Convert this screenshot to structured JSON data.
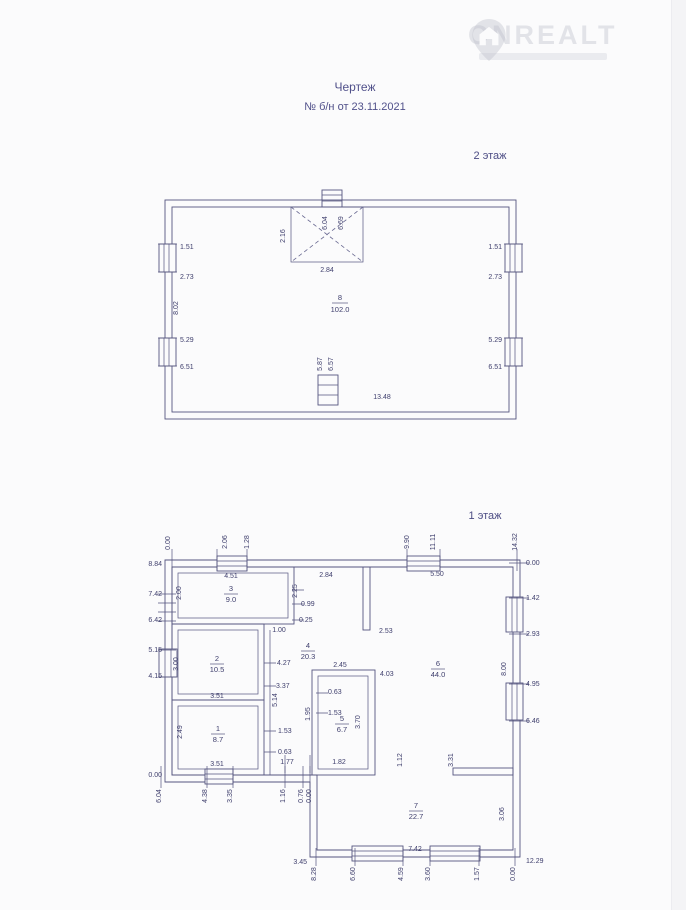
{
  "watermark": {
    "brand": "ONREALT"
  },
  "title": {
    "line1": "Чертеж",
    "line2": "№ б/н от 23.11.2021"
  },
  "colors": {
    "ink": "#55557f",
    "text": "#40406e",
    "accent": "#50508a"
  },
  "floor2": {
    "label": "2 этаж",
    "room": {
      "n": "8",
      "a": "102.0"
    },
    "dims": {
      "left": [
        "1.51",
        "2.73",
        "8.02",
        "5.29",
        "6.51"
      ],
      "right": [
        "1.51",
        "2.73",
        "5.29",
        "6.51"
      ],
      "inner": [
        "6.04",
        "6.69",
        "2.16",
        "2.84",
        "5.87",
        "6.57",
        "13.48"
      ]
    }
  },
  "floor1": {
    "label": "1 этаж",
    "rooms": [
      {
        "n": "1",
        "a": "8.7"
      },
      {
        "n": "2",
        "a": "10.5"
      },
      {
        "n": "3",
        "a": "9.0"
      },
      {
        "n": "4",
        "a": "20.3"
      },
      {
        "n": "5",
        "a": "6.7"
      },
      {
        "n": "6",
        "a": "44.0"
      },
      {
        "n": "7",
        "a": "22.7"
      }
    ],
    "dims": {
      "top": [
        "0.00",
        "2.06",
        "1.28",
        "9.90",
        "11.11",
        "14.32"
      ],
      "left": [
        "8.84",
        "7.42",
        "6.42",
        "5.15",
        "4.15",
        "0.00"
      ],
      "right": [
        "0.00",
        "1.42",
        "2.93",
        "4.95",
        "6.46",
        "12.29"
      ],
      "bottom": [
        "6.04",
        "4.38",
        "3.35",
        "1.16",
        "0.76",
        "0.00"
      ],
      "bottom7": [
        "3.45",
        "8.28",
        "6.60",
        "4.59",
        "3.60",
        "1.57",
        "0.00"
      ],
      "inner": [
        "4.51",
        "2.84",
        "5.50",
        "2.00",
        "2.25",
        "0.99",
        "0.25",
        "1.00",
        "2.53",
        "3.00",
        "4.27",
        "3.37",
        "5.14",
        "3.51",
        "3.51",
        "2.49",
        "1.53",
        "0.63",
        "1.77",
        "2.45",
        "4.03",
        "0.63",
        "1.53",
        "1.95",
        "3.70",
        "1.82",
        "1.12",
        "3.31",
        "8.00",
        "7.42",
        "3.06"
      ]
    }
  }
}
